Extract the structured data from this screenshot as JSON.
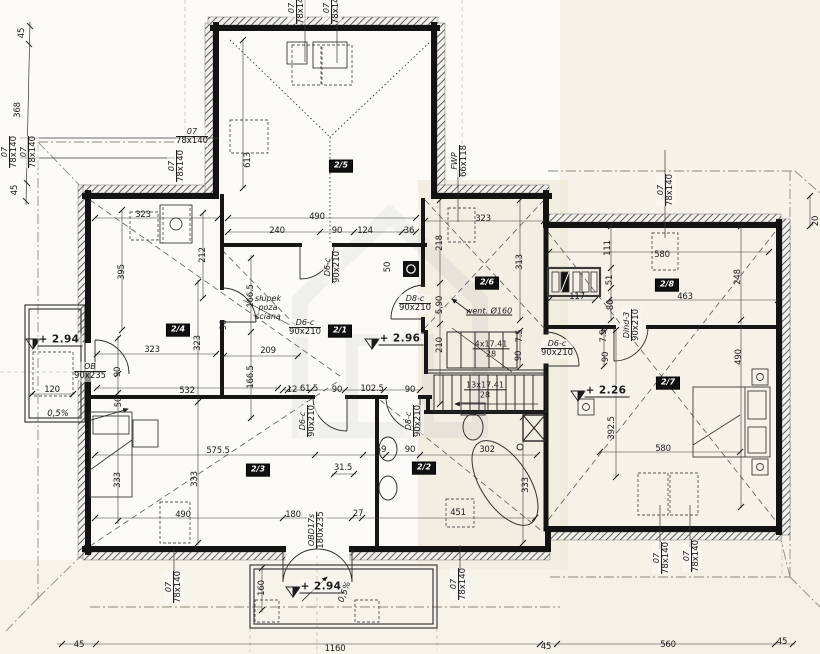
{
  "drawing": {
    "kind": "attic floor plan (scanned architectural drawing)",
    "ink_color": "#1b1b1d",
    "paper_color": "#fbfaf6",
    "scan_tint": "#e8dfca"
  },
  "rooms": [
    {
      "t": "2/5",
      "x": 341,
      "y": 166
    },
    {
      "t": "2/4",
      "x": 178,
      "y": 330
    },
    {
      "t": "2/1",
      "x": 340,
      "y": 331
    },
    {
      "t": "2/6",
      "x": 487,
      "y": 283
    },
    {
      "t": "2/8",
      "x": 667,
      "y": 285
    },
    {
      "t": "2/7",
      "x": 668,
      "y": 383
    },
    {
      "t": "2/3",
      "x": 258,
      "y": 470
    },
    {
      "t": "2/2",
      "x": 424,
      "y": 468
    }
  ],
  "openings": [
    {
      "n": "07",
      "s": "78x140",
      "x": 297,
      "y": 8,
      "r": -90
    },
    {
      "n": "07",
      "s": "78x140",
      "x": 332,
      "y": 8,
      "r": -90
    },
    {
      "n": "07",
      "s": "78x140",
      "x": 10,
      "y": 152,
      "r": -90
    },
    {
      "n": "07",
      "s": "78x140",
      "x": 29,
      "y": 152,
      "r": -90
    },
    {
      "n": "07",
      "s": "78x140",
      "x": 192,
      "y": 137
    },
    {
      "n": "07",
      "s": "78x140",
      "x": 177,
      "y": 166,
      "r": -90
    },
    {
      "n": "FWP",
      "s": "66x118",
      "x": 460,
      "y": 161,
      "r": -90
    },
    {
      "n": "07",
      "s": "78x140",
      "x": 666,
      "y": 190,
      "r": -90
    },
    {
      "n": "07",
      "s": "78x140",
      "x": 174,
      "y": 587,
      "r": -90
    },
    {
      "n": "07",
      "s": "78x140",
      "x": 459,
      "y": 584,
      "r": -90
    },
    {
      "n": "07",
      "s": "78x140",
      "x": 662,
      "y": 558,
      "r": -90
    },
    {
      "n": "07",
      "s": "78x140",
      "x": 692,
      "y": 556,
      "r": -90
    },
    {
      "n": "D6-c",
      "s": "90x210",
      "x": 305,
      "y": 328
    },
    {
      "n": "D6-c",
      "s": "90x210",
      "x": 333,
      "y": 267,
      "r": -90
    },
    {
      "n": "D8-c",
      "s": "90x210",
      "x": 415,
      "y": 304
    },
    {
      "n": "D6-c",
      "s": "90x210",
      "x": 308,
      "y": 421,
      "r": -90
    },
    {
      "n": "D8-c",
      "s": "90x210",
      "x": 414,
      "y": 421,
      "r": -90
    },
    {
      "n": "D6-c",
      "s": "90x210",
      "x": 557,
      "y": 349
    },
    {
      "n": "Dind-3",
      "s": "90x210",
      "x": 632,
      "y": 325,
      "r": -90
    },
    {
      "n": "OB",
      "s": "90x235",
      "x": 90,
      "y": 372
    },
    {
      "n": "OBD17s",
      "s": "180x235",
      "x": 317,
      "y": 530,
      "r": -90
    }
  ],
  "stairs": [
    {
      "n": "4x17.41",
      "s": "28",
      "x": 491,
      "y": 349
    },
    {
      "n": "13x17.41",
      "s": "28",
      "x": 485,
      "y": 390
    }
  ],
  "levels": [
    {
      "t": "+ 2.96",
      "x": 401,
      "y": 339
    },
    {
      "t": "+ 2.26",
      "x": 607,
      "y": 391
    },
    {
      "t": "+ 2.94",
      "x": 60,
      "y": 340
    },
    {
      "t": "+ 2.94",
      "x": 322,
      "y": 587
    }
  ],
  "slopes": [
    {
      "t": "0,5%",
      "x": 58,
      "y": 414
    },
    {
      "t": "0,5%",
      "x": 345,
      "y": 592,
      "r": -70
    }
  ],
  "annotations": [
    {
      "t": "went. Ø160",
      "x": 489,
      "y": 311,
      "c": "note"
    },
    {
      "lines": [
        "słupek",
        "poza",
        "ścianą"
      ],
      "x": 268,
      "y": 308,
      "c": "note3"
    }
  ],
  "dimensions": [
    {
      "t": "323",
      "x": 143,
      "y": 215
    },
    {
      "t": "240",
      "x": 277,
      "y": 231
    },
    {
      "t": "490",
      "x": 317,
      "y": 217
    },
    {
      "t": "90",
      "x": 337,
      "y": 231
    },
    {
      "t": "124",
      "x": 365,
      "y": 231
    },
    {
      "t": "36",
      "x": 409,
      "y": 231
    },
    {
      "t": "613",
      "x": 248,
      "y": 160,
      "r": -90
    },
    {
      "t": "395",
      "x": 122,
      "y": 272,
      "r": -90
    },
    {
      "t": "212",
      "x": 203,
      "y": 255,
      "r": -90
    },
    {
      "t": "218",
      "x": 440,
      "y": 243,
      "r": -90
    },
    {
      "t": "323",
      "x": 483,
      "y": 219
    },
    {
      "t": "313",
      "x": 520,
      "y": 262,
      "r": -90
    },
    {
      "t": "50",
      "x": 388,
      "y": 267,
      "r": -90
    },
    {
      "t": "166.5",
      "x": 251,
      "y": 296,
      "r": -90
    },
    {
      "t": "166.5",
      "x": 251,
      "y": 377,
      "r": -90
    },
    {
      "t": "90",
      "x": 224,
      "y": 325,
      "r": -90
    },
    {
      "t": "209",
      "x": 268,
      "y": 351
    },
    {
      "t": "323",
      "x": 152,
      "y": 350
    },
    {
      "t": "323",
      "x": 198,
      "y": 343,
      "r": -90
    },
    {
      "t": "5,90",
      "x": 440,
      "y": 305,
      "r": -90
    },
    {
      "t": "90",
      "x": 118,
      "y": 372,
      "r": -90
    },
    {
      "t": "50",
      "x": 119,
      "y": 402,
      "r": -90
    },
    {
      "t": "120",
      "x": 52,
      "y": 390
    },
    {
      "t": "532",
      "x": 187,
      "y": 391
    },
    {
      "t": "12",
      "x": 292,
      "y": 390
    },
    {
      "t": "61.5",
      "x": 309,
      "y": 389
    },
    {
      "t": "90",
      "x": 337,
      "y": 390
    },
    {
      "t": "102.5",
      "x": 372,
      "y": 389
    },
    {
      "t": "90",
      "x": 410,
      "y": 390
    },
    {
      "t": "210",
      "x": 440,
      "y": 345,
      "r": -90
    },
    {
      "t": "7.5",
      "x": 520,
      "y": 336,
      "r": -90
    },
    {
      "t": "90",
      "x": 519,
      "y": 356,
      "r": -90
    },
    {
      "t": "575.5",
      "x": 218,
      "y": 451
    },
    {
      "t": "59",
      "x": 381,
      "y": 450
    },
    {
      "t": "90",
      "x": 410,
      "y": 450
    },
    {
      "t": "302",
      "x": 487,
      "y": 450
    },
    {
      "t": "333",
      "x": 118,
      "y": 480,
      "r": -90
    },
    {
      "t": "333",
      "x": 195,
      "y": 479,
      "r": -90
    },
    {
      "t": "333",
      "x": 526,
      "y": 485,
      "r": -90
    },
    {
      "t": "490",
      "x": 183,
      "y": 515
    },
    {
      "t": "180",
      "x": 293,
      "y": 515
    },
    {
      "t": "27",
      "x": 358,
      "y": 514
    },
    {
      "t": "451",
      "x": 458,
      "y": 513
    },
    {
      "t": "31.5",
      "x": 343,
      "y": 468
    },
    {
      "t": "117",
      "x": 577,
      "y": 297
    },
    {
      "t": "111",
      "x": 608,
      "y": 248,
      "r": -90
    },
    {
      "t": "51",
      "x": 610,
      "y": 280,
      "r": -90
    },
    {
      "t": "86",
      "x": 611,
      "y": 305,
      "r": -90
    },
    {
      "t": "580",
      "x": 662,
      "y": 255
    },
    {
      "t": "463",
      "x": 685,
      "y": 297
    },
    {
      "t": "248",
      "x": 738,
      "y": 277,
      "r": -90
    },
    {
      "t": "490",
      "x": 739,
      "y": 357,
      "r": -90
    },
    {
      "t": "7.5",
      "x": 604,
      "y": 336,
      "r": -90
    },
    {
      "t": "90",
      "x": 606,
      "y": 357,
      "r": -90
    },
    {
      "t": "392.5",
      "x": 612,
      "y": 428,
      "r": -90
    },
    {
      "t": "580",
      "x": 663,
      "y": 449
    },
    {
      "t": "160",
      "x": 262,
      "y": 588,
      "r": -90
    },
    {
      "t": "1160",
      "x": 335,
      "y": 649
    },
    {
      "t": "45",
      "x": 79,
      "y": 645
    },
    {
      "t": "45",
      "x": 546,
      "y": 647
    },
    {
      "t": "560",
      "x": 668,
      "y": 645
    },
    {
      "t": "45",
      "x": 782,
      "y": 642
    },
    {
      "t": "45",
      "x": 22,
      "y": 33,
      "r": -90
    },
    {
      "t": "368",
      "x": 18,
      "y": 110,
      "r": -90
    },
    {
      "t": "45",
      "x": 15,
      "y": 190,
      "r": -90
    },
    {
      "t": "20",
      "x": 816,
      "y": 221,
      "r": -90
    }
  ]
}
